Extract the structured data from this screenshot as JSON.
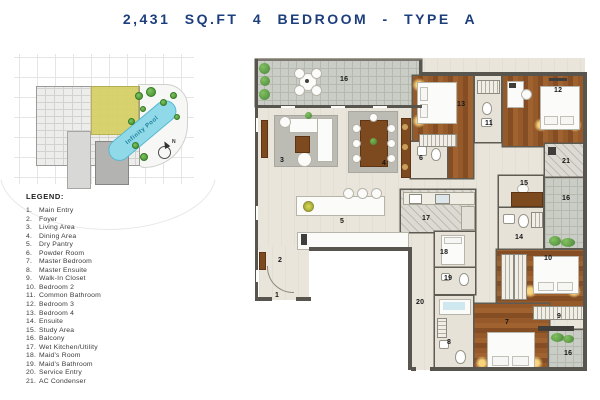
{
  "title": "2,431 SQ.FT 4 BEDROOM - TYPE A",
  "colors": {
    "title_navy": "#1d3e7d",
    "wall_gray": "#57554d",
    "wood_floor": "#96592a",
    "balcony_tile": "#c9cdc5",
    "pool_blue": "#8fd9e9",
    "highlight_unit_yellow": "#d6d063",
    "glow_yellow": "#ffdb80"
  },
  "key_plan": {
    "pool_label": "Infinity Pool",
    "compass_label": "N"
  },
  "legend": {
    "title": "LEGEND:",
    "items": [
      {
        "num": "1.",
        "label": "Main Entry"
      },
      {
        "num": "2.",
        "label": "Foyer"
      },
      {
        "num": "3.",
        "label": "Living Area"
      },
      {
        "num": "4.",
        "label": "Dining Area"
      },
      {
        "num": "5.",
        "label": "Dry Pantry"
      },
      {
        "num": "6.",
        "label": "Powder Room"
      },
      {
        "num": "7.",
        "label": "Master Bedroom"
      },
      {
        "num": "8.",
        "label": "Master Ensuite"
      },
      {
        "num": "9.",
        "label": "Walk-In Closet"
      },
      {
        "num": "10.",
        "label": "Bedroom 2"
      },
      {
        "num": "11.",
        "label": "Common Bathroom"
      },
      {
        "num": "12.",
        "label": "Bedroom 3"
      },
      {
        "num": "13.",
        "label": "Bedroom 4"
      },
      {
        "num": "14.",
        "label": "Ensuite"
      },
      {
        "num": "15.",
        "label": "Study Area"
      },
      {
        "num": "16.",
        "label": "Balcony"
      },
      {
        "num": "17.",
        "label": "Wet Kitchen/Utility"
      },
      {
        "num": "18.",
        "label": "Maid's Room"
      },
      {
        "num": "19.",
        "label": "Maid's Bathroom"
      },
      {
        "num": "20.",
        "label": "Service Entry"
      },
      {
        "num": "21.",
        "label": "AC Condenser"
      }
    ]
  },
  "floor_plan": {
    "labels": [
      {
        "num": "1",
        "x": 22,
        "y": 236
      },
      {
        "num": "2",
        "x": 25,
        "y": 201
      },
      {
        "num": "3",
        "x": 27,
        "y": 101
      },
      {
        "num": "4",
        "x": 129,
        "y": 104
      },
      {
        "num": "5",
        "x": 87,
        "y": 162
      },
      {
        "num": "6",
        "x": 166,
        "y": 99
      },
      {
        "num": "7",
        "x": 252,
        "y": 263
      },
      {
        "num": "8",
        "x": 194,
        "y": 283
      },
      {
        "num": "9",
        "x": 304,
        "y": 257
      },
      {
        "num": "10",
        "x": 291,
        "y": 199
      },
      {
        "num": "11",
        "x": 232,
        "y": 64
      },
      {
        "num": "12",
        "x": 301,
        "y": 31
      },
      {
        "num": "13",
        "x": 204,
        "y": 45
      },
      {
        "num": "14",
        "x": 262,
        "y": 178
      },
      {
        "num": "15",
        "x": 267,
        "y": 124
      },
      {
        "num": "16",
        "x": 87,
        "y": 20
      },
      {
        "num": "16",
        "x": 309,
        "y": 139
      },
      {
        "num": "16",
        "x": 311,
        "y": 294
      },
      {
        "num": "17",
        "x": 169,
        "y": 159
      },
      {
        "num": "18",
        "x": 187,
        "y": 193
      },
      {
        "num": "19",
        "x": 191,
        "y": 219
      },
      {
        "num": "20",
        "x": 163,
        "y": 243
      },
      {
        "num": "21",
        "x": 309,
        "y": 102
      }
    ]
  }
}
